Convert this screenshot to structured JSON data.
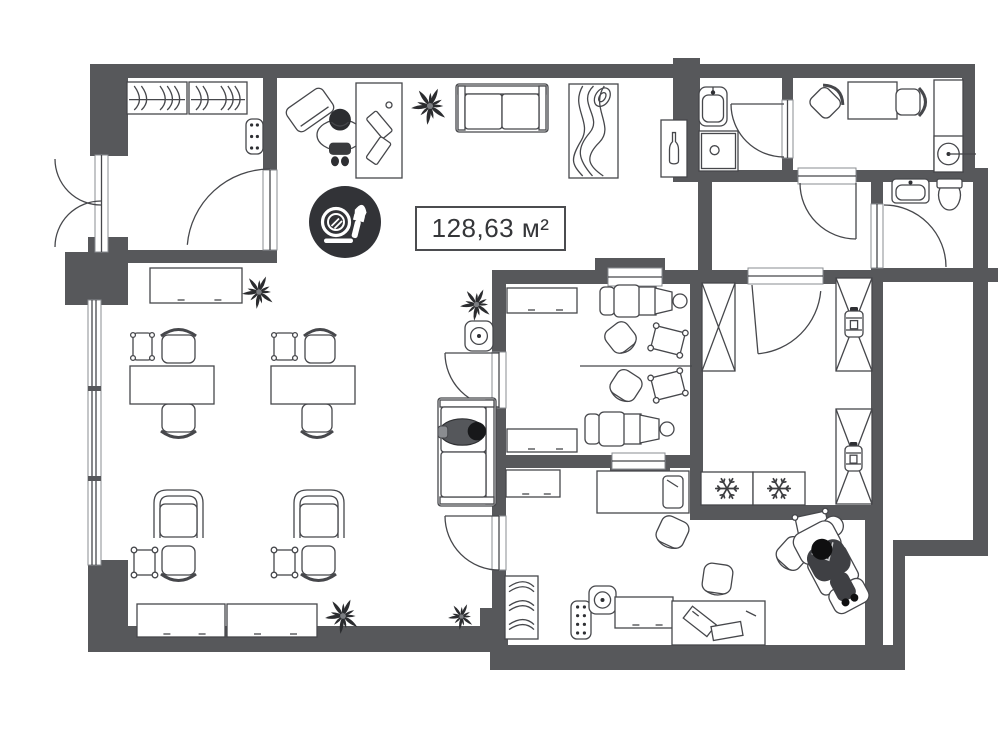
{
  "title": "Beauty salon floor plan",
  "area": {
    "text": "128,63 м²"
  },
  "badge_icon": "makeup-icon",
  "palette": {
    "wall": "#57585B",
    "line": "#46474B",
    "dark": "#323337",
    "floor": "#FFFFFF"
  },
  "scene": {
    "walls": [
      [
        90,
        64,
        885,
        14
      ],
      [
        90,
        64,
        38,
        92
      ],
      [
        104,
        237,
        24,
        16
      ],
      [
        88,
        237,
        40,
        68
      ],
      [
        65,
        252,
        25,
        53
      ],
      [
        88,
        560,
        40,
        92
      ],
      [
        88,
        626,
        420,
        26
      ],
      [
        490,
        645,
        415,
        25
      ],
      [
        480,
        608,
        28,
        44
      ],
      [
        123,
        250,
        154,
        13
      ],
      [
        263,
        64,
        14,
        108
      ],
      [
        263,
        248,
        14,
        15
      ],
      [
        673,
        58,
        27,
        124
      ],
      [
        782,
        64,
        11,
        108
      ],
      [
        962,
        64,
        13,
        112
      ],
      [
        962,
        168,
        26,
        14
      ],
      [
        973,
        168,
        15,
        388
      ],
      [
        686,
        170,
        114,
        12
      ],
      [
        855,
        170,
        120,
        12
      ],
      [
        698,
        180,
        14,
        92
      ],
      [
        871,
        182,
        12,
        24
      ],
      [
        871,
        268,
        127,
        14
      ],
      [
        492,
        270,
        120,
        14
      ],
      [
        660,
        270,
        42,
        14
      ],
      [
        595,
        258,
        70,
        13
      ],
      [
        690,
        270,
        13,
        250
      ],
      [
        703,
        270,
        47,
        14
      ],
      [
        821,
        270,
        52,
        14
      ],
      [
        871,
        270,
        12,
        272
      ],
      [
        690,
        505,
        193,
        15
      ],
      [
        893,
        540,
        95,
        16
      ],
      [
        893,
        540,
        12,
        130
      ],
      [
        865,
        520,
        18,
        132
      ],
      [
        492,
        282,
        14,
        72
      ],
      [
        492,
        406,
        14,
        112
      ],
      [
        492,
        568,
        14,
        60
      ],
      [
        492,
        455,
        122,
        13
      ],
      [
        663,
        455,
        40,
        13
      ],
      [
        610,
        468,
        60,
        13
      ]
    ],
    "window": {
      "rect": [
        88,
        300,
        13,
        265
      ],
      "mullions": [
        386,
        476
      ]
    },
    "frames": [
      [
        95,
        155,
        13,
        97
      ],
      [
        263,
        170,
        14,
        80
      ],
      [
        608,
        268,
        54,
        18
      ],
      [
        612,
        453,
        53,
        16
      ],
      [
        798,
        168,
        58,
        16
      ],
      [
        871,
        204,
        12,
        64
      ],
      [
        782,
        100,
        11,
        58
      ],
      [
        748,
        268,
        75,
        16
      ],
      [
        492,
        352,
        14,
        56
      ],
      [
        492,
        516,
        14,
        54
      ]
    ],
    "doors": [
      {
        "hx": 101,
        "hy": 159,
        "r": 46,
        "a0": 90,
        "a1": 180
      },
      {
        "hx": 101,
        "hy": 247,
        "r": 46,
        "a0": 270,
        "a1": 180
      },
      {
        "hx": 270,
        "hy": 252,
        "r": 83,
        "a0": 270,
        "a1": 185
      },
      {
        "hx": 499,
        "hy": 353,
        "r": 54,
        "a0": 90,
        "a1": 180,
        "leaf": 180
      },
      {
        "hx": 499,
        "hy": 516,
        "r": 54,
        "a0": 90,
        "a1": 180,
        "leaf": 180
      },
      {
        "hx": 752,
        "hy": 285,
        "r": 69,
        "a0": 5,
        "a1": 85,
        "leaf": 85
      },
      {
        "hx": 856,
        "hy": 183,
        "r": 56,
        "a0": 90,
        "a1": 180,
        "leaf": 90
      },
      {
        "hx": 884,
        "hy": 267,
        "r": 62,
        "a0": 270,
        "a1": 360
      },
      {
        "hx": 784,
        "hy": 104,
        "r": 53,
        "a0": 180,
        "a1": 90,
        "leaf": 180
      }
    ],
    "lines": [
      [
        580,
        366,
        692,
        366
      ],
      [
        963,
        154,
        976,
        154
      ]
    ],
    "furniture": [
      {
        "t": "hangrail",
        "x": 127,
        "y": 82,
        "w": 60,
        "h": 32
      },
      {
        "t": "hangrail",
        "x": 189,
        "y": 82,
        "w": 58,
        "h": 32
      },
      {
        "t": "radiator",
        "x": 246,
        "y": 119,
        "w": 17,
        "h": 35
      },
      {
        "t": "board",
        "x": 288,
        "y": 96,
        "w": 44,
        "h": 28,
        "r": -35
      },
      {
        "t": "person",
        "x": 315,
        "y": 103,
        "w": 50,
        "h": 64
      },
      {
        "t": "deskv",
        "x": 356,
        "y": 83,
        "w": 46,
        "h": 95
      },
      {
        "t": "plant",
        "x": 411,
        "y": 87,
        "w": 38,
        "h": 38
      },
      {
        "t": "sofa",
        "x": 456,
        "y": 84,
        "w": 92,
        "h": 48
      },
      {
        "t": "rug",
        "x": 569,
        "y": 84,
        "w": 49,
        "h": 94
      },
      {
        "t": "bottlecab",
        "x": 661,
        "y": 120,
        "w": 26,
        "h": 57
      },
      {
        "t": "cabinet",
        "x": 150,
        "y": 268,
        "w": 92,
        "h": 35
      },
      {
        "t": "plant",
        "x": 242,
        "y": 275,
        "w": 34,
        "h": 34
      },
      {
        "t": "plant",
        "x": 460,
        "y": 288,
        "w": 33,
        "h": 33
      },
      {
        "t": "speaker",
        "x": 465,
        "y": 321,
        "w": 28,
        "h": 30
      },
      {
        "t": "smallchair",
        "x": 131,
        "y": 331,
        "w": 23,
        "h": 31
      },
      {
        "t": "chair",
        "x": 159,
        "y": 327,
        "w": 39,
        "h": 36,
        "r": 180
      },
      {
        "t": "chair",
        "x": 159,
        "y": 404,
        "w": 39,
        "h": 36
      },
      {
        "t": "table",
        "x": 130,
        "y": 366,
        "w": 84,
        "h": 38
      },
      {
        "t": "smallchair",
        "x": 272,
        "y": 331,
        "w": 25,
        "h": 31
      },
      {
        "t": "chair",
        "x": 302,
        "y": 327,
        "w": 36,
        "h": 36,
        "r": 180
      },
      {
        "t": "chair",
        "x": 299,
        "y": 404,
        "w": 36,
        "h": 36
      },
      {
        "t": "table",
        "x": 271,
        "y": 366,
        "w": 84,
        "h": 38
      },
      {
        "t": "sofa",
        "x": 413,
        "y": 423,
        "w": 108,
        "h": 58,
        "r": 90
      },
      {
        "t": "personsit",
        "x": 438,
        "y": 412,
        "w": 54,
        "h": 40
      },
      {
        "t": "armchair",
        "x": 151,
        "y": 487,
        "w": 55,
        "h": 51
      },
      {
        "t": "minitable",
        "x": 131,
        "y": 547,
        "w": 27,
        "h": 31
      },
      {
        "t": "chair",
        "x": 159,
        "y": 546,
        "w": 39,
        "h": 37
      },
      {
        "t": "armchair",
        "x": 291,
        "y": 487,
        "w": 56,
        "h": 51
      },
      {
        "t": "minitable",
        "x": 271,
        "y": 547,
        "w": 27,
        "h": 31
      },
      {
        "t": "chair",
        "x": 299,
        "y": 546,
        "w": 39,
        "h": 37
      },
      {
        "t": "cabinet",
        "x": 137,
        "y": 604,
        "w": 88,
        "h": 33
      },
      {
        "t": "cabinet",
        "x": 227,
        "y": 604,
        "w": 90,
        "h": 33
      },
      {
        "t": "plant",
        "x": 325,
        "y": 598,
        "w": 36,
        "h": 36
      },
      {
        "t": "plant",
        "x": 448,
        "y": 603,
        "w": 27,
        "h": 27
      },
      {
        "t": "cabinet",
        "x": 507,
        "y": 288,
        "w": 70,
        "h": 25
      },
      {
        "t": "cabinet",
        "x": 507,
        "y": 429,
        "w": 70,
        "h": 23
      },
      {
        "t": "recliner",
        "x": 600,
        "y": 283,
        "w": 88,
        "h": 36
      },
      {
        "t": "stool",
        "x": 604,
        "y": 321,
        "w": 33,
        "h": 33,
        "r": -38
      },
      {
        "t": "minitable",
        "x": 650,
        "y": 326,
        "w": 36,
        "h": 29,
        "r": 14
      },
      {
        "t": "stool",
        "x": 609,
        "y": 369,
        "w": 34,
        "h": 33,
        "r": 33
      },
      {
        "t": "minitable",
        "x": 650,
        "y": 371,
        "w": 36,
        "h": 29,
        "r": -14
      },
      {
        "t": "recliner",
        "x": 585,
        "y": 410,
        "w": 90,
        "h": 38
      },
      {
        "t": "xcab",
        "x": 702,
        "y": 283,
        "w": 33,
        "h": 88
      },
      {
        "t": "xcab",
        "x": 836,
        "y": 278,
        "w": 36,
        "h": 93
      },
      {
        "t": "jar",
        "x": 844,
        "y": 307,
        "w": 20,
        "h": 34
      },
      {
        "t": "xcab",
        "x": 836,
        "y": 409,
        "w": 36,
        "h": 95
      },
      {
        "t": "jar",
        "x": 844,
        "y": 442,
        "w": 19,
        "h": 33
      },
      {
        "t": "freezer",
        "x": 701,
        "y": 472,
        "w": 52,
        "h": 33
      },
      {
        "t": "freezer",
        "x": 753,
        "y": 472,
        "w": 52,
        "h": 33
      },
      {
        "t": "sinkv",
        "x": 699,
        "y": 87,
        "w": 28,
        "h": 39
      },
      {
        "t": "shower",
        "x": 699,
        "y": 131,
        "w": 39,
        "h": 40
      },
      {
        "t": "chair",
        "x": 812,
        "y": 84,
        "w": 32,
        "h": 32,
        "r": -135
      },
      {
        "t": "table",
        "x": 848,
        "y": 82,
        "w": 49,
        "h": 37
      },
      {
        "t": "chair",
        "x": 896,
        "y": 86,
        "w": 32,
        "h": 32,
        "r": -90
      },
      {
        "t": "table",
        "x": 934,
        "y": 80,
        "w": 29,
        "h": 92
      },
      {
        "t": "washer",
        "x": 934,
        "y": 136,
        "w": 29,
        "h": 36
      },
      {
        "t": "sinkh",
        "x": 892,
        "y": 179,
        "w": 37,
        "h": 24
      },
      {
        "t": "toilet",
        "x": 937,
        "y": 179,
        "w": 25,
        "h": 31
      },
      {
        "t": "cabinet",
        "x": 506,
        "y": 470,
        "w": 54,
        "h": 27
      },
      {
        "t": "bed",
        "x": 597,
        "y": 471,
        "w": 92,
        "h": 42
      },
      {
        "t": "stool",
        "x": 655,
        "y": 515,
        "w": 35,
        "h": 34,
        "r": 25
      },
      {
        "t": "stool",
        "x": 700,
        "y": 561,
        "w": 35,
        "h": 35,
        "r": 8
      },
      {
        "t": "minitable",
        "x": 794,
        "y": 511,
        "w": 37,
        "h": 29,
        "r": -12
      },
      {
        "t": "stool",
        "x": 776,
        "y": 536,
        "w": 34,
        "h": 35,
        "r": 42
      },
      {
        "t": "client",
        "x": 800,
        "y": 518,
        "w": 70,
        "h": 95,
        "r": -28
      },
      {
        "t": "coatrack",
        "x": 505,
        "y": 576,
        "w": 33,
        "h": 63
      },
      {
        "t": "radiator",
        "x": 571,
        "y": 601,
        "w": 20,
        "h": 38
      },
      {
        "t": "speaker",
        "x": 589,
        "y": 586,
        "w": 27,
        "h": 28
      },
      {
        "t": "cabinet",
        "x": 615,
        "y": 597,
        "w": 58,
        "h": 31
      },
      {
        "t": "deskpapers",
        "x": 672,
        "y": 601,
        "w": 93,
        "h": 44
      }
    ]
  }
}
